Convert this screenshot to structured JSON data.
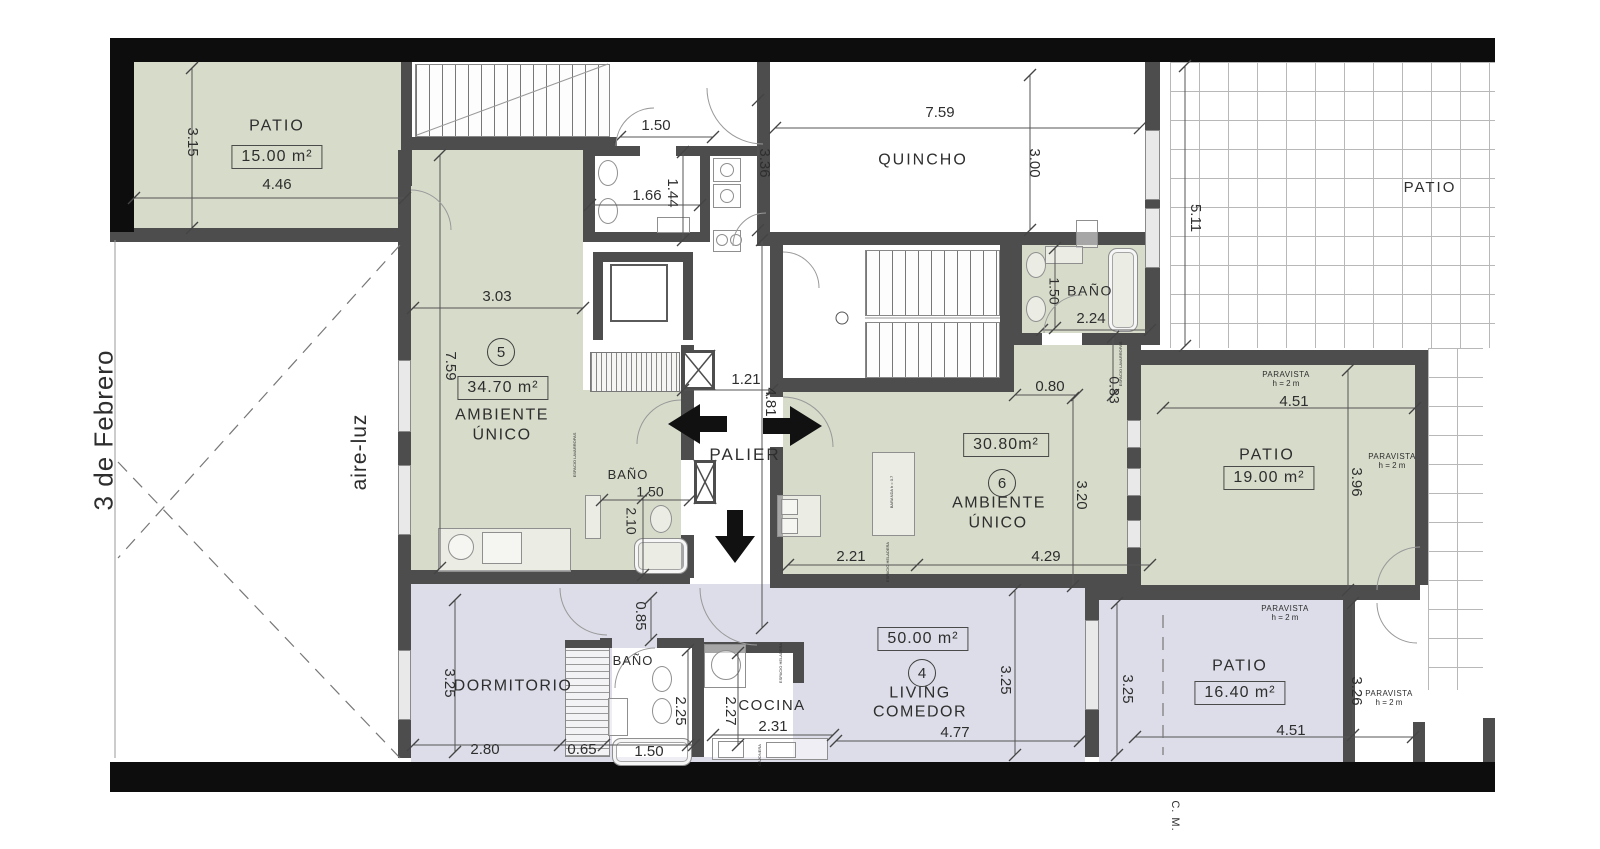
{
  "colors": {
    "room_green": "#d6dbca",
    "room_lavender": "#dcdde8",
    "wall": "#4d4d4d",
    "boundary": "#0d0d0d",
    "dim_text": "#2e2e2e"
  },
  "texts": [
    {
      "name": "street-name",
      "text": "3 de Febrero",
      "x": 104,
      "y": 430,
      "size": 26,
      "rot": -90,
      "ls": 1
    },
    {
      "name": "aire-luz-label",
      "text": "aire-luz",
      "x": 360,
      "y": 452,
      "size": 21,
      "rot": -90,
      "ls": 1
    },
    {
      "name": "cm-label",
      "text": "C. M.",
      "x": 1174,
      "y": 816,
      "size": 11,
      "rot": 90,
      "ls": 1
    },
    {
      "name": "room-label-patio-15",
      "text": "PATIO",
      "x": 277,
      "y": 127,
      "size": 16,
      "ls": 2
    },
    {
      "name": "room-label-quincho",
      "text": "QUINCHO",
      "x": 923,
      "y": 161,
      "size": 16,
      "ls": 2
    },
    {
      "name": "room-label-patio-upper-right",
      "text": "PATIO",
      "x": 1430,
      "y": 188,
      "size": 15,
      "ls": 2
    },
    {
      "name": "room-label-palier",
      "text": "PALIER",
      "x": 745,
      "y": 455,
      "size": 17,
      "ls": 2
    },
    {
      "name": "unit5-name-line1",
      "text": "AMBIENTE",
      "x": 502,
      "y": 416,
      "size": 16,
      "ls": 1.5
    },
    {
      "name": "unit5-name-line2",
      "text": "ÚNICO",
      "x": 502,
      "y": 436,
      "size": 16,
      "ls": 1.5
    },
    {
      "name": "unit6-name-line1",
      "text": "AMBIENTE",
      "x": 999,
      "y": 504,
      "size": 16,
      "ls": 1.5
    },
    {
      "name": "unit6-name-line2",
      "text": "ÚNICO",
      "x": 998,
      "y": 524,
      "size": 16,
      "ls": 1.5
    },
    {
      "name": "unit4-name-line1",
      "text": "LIVING",
      "x": 920,
      "y": 694,
      "size": 16,
      "ls": 1.5
    },
    {
      "name": "unit4-name-line2",
      "text": "COMEDOR",
      "x": 920,
      "y": 713,
      "size": 16,
      "ls": 1.5
    },
    {
      "name": "room-label-dormitorio",
      "text": "DORMITORIO",
      "x": 513,
      "y": 687,
      "size": 16,
      "ls": 1.5
    },
    {
      "name": "room-label-cocina",
      "text": "COCINA",
      "x": 772,
      "y": 706,
      "size": 15,
      "ls": 1.5
    },
    {
      "name": "room-label-bano-upper",
      "text": "BAÑO",
      "x": 1090,
      "y": 291,
      "size": 14,
      "ls": 1.5
    },
    {
      "name": "room-label-bano-unit5",
      "text": "BAÑO",
      "x": 628,
      "y": 475,
      "size": 13,
      "ls": 1
    },
    {
      "name": "room-label-bano-unit4",
      "text": "BAÑO",
      "x": 633,
      "y": 661,
      "size": 13,
      "ls": 1
    },
    {
      "name": "room-label-patio-19",
      "text": "PATIO",
      "x": 1267,
      "y": 456,
      "size": 16,
      "ls": 2
    },
    {
      "name": "room-label-patio-16",
      "text": "PATIO",
      "x": 1240,
      "y": 667,
      "size": 16,
      "ls": 2
    },
    {
      "name": "paravista-1-line1",
      "text": "PARAVISTA",
      "x": 1286,
      "y": 375,
      "size": 8,
      "ls": 0.5
    },
    {
      "name": "paravista-1-line2",
      "text": "h = 2 m",
      "x": 1286,
      "y": 384,
      "size": 8
    },
    {
      "name": "paravista-2-line1",
      "text": "PARAVISTA",
      "x": 1392,
      "y": 457,
      "size": 8,
      "ls": 0.5
    },
    {
      "name": "paravista-2-line2",
      "text": "h = 2 m",
      "x": 1392,
      "y": 466,
      "size": 8
    },
    {
      "name": "paravista-3-line1",
      "text": "PARAVISTA",
      "x": 1285,
      "y": 609,
      "size": 8,
      "ls": 0.5
    },
    {
      "name": "paravista-3-line2",
      "text": "h = 2 m",
      "x": 1285,
      "y": 618,
      "size": 8
    },
    {
      "name": "paravista-4-line1",
      "text": "PARAVISTA",
      "x": 1389,
      "y": 694,
      "size": 8,
      "ls": 0.5
    },
    {
      "name": "paravista-4-line2",
      "text": "h = 2 m",
      "x": 1389,
      "y": 703,
      "size": 8
    },
    {
      "name": "espacio-lavarropas-1",
      "text": "ESPACIO LAVARROPAS",
      "x": 575,
      "y": 455,
      "size": 4,
      "rot": -90
    },
    {
      "name": "espacio-lavarropas-2",
      "text": "ESPACIO LAVARROPAS",
      "x": 1121,
      "y": 364,
      "size": 4,
      "rot": -90
    },
    {
      "name": "baranda-label",
      "text": "BARANDA h = 0.7",
      "x": 892,
      "y": 492,
      "size": 4,
      "rot": -90
    },
    {
      "name": "espacio-heladera-1",
      "text": "ESPACIO HELADERA",
      "x": 888,
      "y": 562,
      "size": 4,
      "rot": -90
    },
    {
      "name": "espacio-heladera-2",
      "text": "ESPACIO HELADERA",
      "x": 781,
      "y": 663,
      "size": 4,
      "rot": -90
    },
    {
      "name": "cajonera-label",
      "text": "CAJONERA",
      "x": 760,
      "y": 755,
      "size": 4,
      "rot": -90
    },
    {
      "name": "dim-patio15-width",
      "text": "4.46",
      "x": 277,
      "y": 185,
      "size": 15
    },
    {
      "name": "dim-patio15-height",
      "text": "3.15",
      "x": 192,
      "y": 142,
      "size": 15,
      "rot": 90
    },
    {
      "name": "dim-top-door",
      "text": "1.50",
      "x": 656,
      "y": 126,
      "size": 15
    },
    {
      "name": "dim-bath-top-width",
      "text": "1.66",
      "x": 647,
      "y": 196,
      "size": 15
    },
    {
      "name": "dim-bath-top-height",
      "text": "1.44",
      "x": 672,
      "y": 193,
      "size": 15,
      "rot": 90
    },
    {
      "name": "dim-corridor",
      "text": "3.36",
      "x": 764,
      "y": 163,
      "size": 15,
      "rot": 90
    },
    {
      "name": "dim-quincho-width",
      "text": "7.59",
      "x": 940,
      "y": 113,
      "size": 15
    },
    {
      "name": "dim-quincho-height",
      "text": "3.00",
      "x": 1034,
      "y": 163,
      "size": 15,
      "rot": 90
    },
    {
      "name": "dim-patio-right-height",
      "text": "5.11",
      "x": 1195,
      "y": 218,
      "size": 15,
      "rot": 90
    },
    {
      "name": "dim-unit5-width",
      "text": "3.03",
      "x": 497,
      "y": 297,
      "size": 15
    },
    {
      "name": "dim-unit5-height",
      "text": "7.59",
      "x": 450,
      "y": 366,
      "size": 15,
      "rot": 90
    },
    {
      "name": "dim-palier-width",
      "text": "1.21",
      "x": 746,
      "y": 380,
      "size": 15
    },
    {
      "name": "dim-palier-length",
      "text": "4.81",
      "x": 770,
      "y": 402,
      "size": 15,
      "rot": 90
    },
    {
      "name": "dim-bano5-width",
      "text": "1.50",
      "x": 650,
      "y": 492,
      "size": 14
    },
    {
      "name": "dim-bano5-height",
      "text": "2.10",
      "x": 631,
      "y": 521,
      "size": 14,
      "rot": 90
    },
    {
      "name": "dim-unit6-seg1",
      "text": "2.21",
      "x": 851,
      "y": 557,
      "size": 15
    },
    {
      "name": "dim-unit6-seg2",
      "text": "4.29",
      "x": 1046,
      "y": 557,
      "size": 15
    },
    {
      "name": "dim-unit6-pass-width",
      "text": "0.80",
      "x": 1050,
      "y": 387,
      "size": 15
    },
    {
      "name": "dim-unit6-height",
      "text": "3.20",
      "x": 1081,
      "y": 495,
      "size": 15,
      "rot": 90
    },
    {
      "name": "dim-bano6-width",
      "text": "1.50",
      "x": 1054,
      "y": 291,
      "size": 14,
      "rot": 90
    },
    {
      "name": "dim-bano6-length",
      "text": "2.24",
      "x": 1091,
      "y": 319,
      "size": 15
    },
    {
      "name": "dim-unit6-pass-height",
      "text": "0.83",
      "x": 1114,
      "y": 390,
      "size": 14,
      "rot": 90
    },
    {
      "name": "dim-patio19-width",
      "text": "4.51",
      "x": 1294,
      "y": 402,
      "size": 15
    },
    {
      "name": "dim-patio19-height",
      "text": "3.96",
      "x": 1356,
      "y": 482,
      "size": 15,
      "rot": 90
    },
    {
      "name": "dim-patio16-width",
      "text": "4.51",
      "x": 1291,
      "y": 731,
      "size": 15
    },
    {
      "name": "dim-patio16-height",
      "text": "3.26",
      "x": 1356,
      "y": 691,
      "size": 15,
      "rot": 90
    },
    {
      "name": "dim-patio16-left-height",
      "text": "3.25",
      "x": 1127,
      "y": 689,
      "size": 15,
      "rot": 90
    },
    {
      "name": "dim-living-height",
      "text": "3.25",
      "x": 1005,
      "y": 680,
      "size": 15,
      "rot": 90
    },
    {
      "name": "dim-dormitorio-height",
      "text": "3.25",
      "x": 449,
      "y": 683,
      "size": 15,
      "rot": 90
    },
    {
      "name": "dim-dormitorio-width",
      "text": "2.80",
      "x": 485,
      "y": 750,
      "size": 15
    },
    {
      "name": "dim-placard",
      "text": "0.65",
      "x": 582,
      "y": 750,
      "size": 15
    },
    {
      "name": "dim-bano4-width",
      "text": "1.50",
      "x": 649,
      "y": 752,
      "size": 15
    },
    {
      "name": "dim-bano4-height",
      "text": "2.25",
      "x": 680,
      "y": 711,
      "size": 15,
      "rot": 90
    },
    {
      "name": "dim-vestibulo",
      "text": "0.85",
      "x": 640,
      "y": 616,
      "size": 15,
      "rot": 90
    },
    {
      "name": "dim-cocina-height",
      "text": "2.27",
      "x": 730,
      "y": 711,
      "size": 15,
      "rot": 90
    },
    {
      "name": "dim-cocina-width",
      "text": "2.31",
      "x": 773,
      "y": 727,
      "size": 15
    },
    {
      "name": "dim-living-width",
      "text": "4.77",
      "x": 955,
      "y": 733,
      "size": 15
    }
  ],
  "area_boxes": [
    {
      "name": "area-patio-15",
      "text": "15.00 m²",
      "x": 277,
      "y": 157
    },
    {
      "name": "area-unit-5",
      "text": "34.70 m²",
      "x": 503,
      "y": 388
    },
    {
      "name": "area-unit-6",
      "text": "30.80m²",
      "x": 1006,
      "y": 445
    },
    {
      "name": "area-patio-19",
      "text": "19.00 m²",
      "x": 1269,
      "y": 478
    },
    {
      "name": "area-unit-4",
      "text": "50.00 m²",
      "x": 923,
      "y": 639
    },
    {
      "name": "area-patio-16",
      "text": "16.40 m²",
      "x": 1240,
      "y": 693
    }
  ],
  "unit_markers": [
    {
      "name": "unit-number-5",
      "text": "5",
      "x": 501,
      "y": 352
    },
    {
      "name": "unit-number-6",
      "text": "6",
      "x": 1002,
      "y": 483
    },
    {
      "name": "unit-number-4",
      "text": "4",
      "x": 922,
      "y": 673
    }
  ]
}
